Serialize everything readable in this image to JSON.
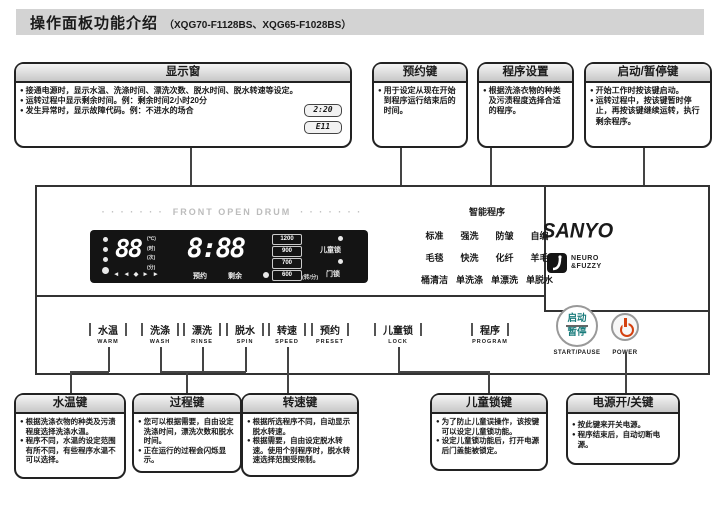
{
  "header": {
    "title": "操作面板功能介绍",
    "models": "（XQG70-F1128BS、XQG65-F1028BS）"
  },
  "callouts_top": {
    "display": {
      "title": "显示窗",
      "bullets": [
        "接通电源时，显示水温、洗涤时间、漂洗次数、脱水时间、脱水转速等设定。",
        "运转过程中显示剩余时间。例：剩余时间2小时20分",
        "发生异常时，显示故障代码。例：不进水的场合"
      ],
      "examples": [
        "2:20",
        "E11"
      ]
    },
    "preset": {
      "title": "预约键",
      "bullets": [
        "用于设定从现在开始到程序运行结束后的时间。"
      ]
    },
    "program": {
      "title": "程序设置",
      "bullets": [
        "根据洗涤衣物的种类及污渍程度选择合适的程序。"
      ]
    },
    "start_pause": {
      "title": "启动/暂停键",
      "bullets": [
        "开始工作时按该键启动。",
        "运转过程中，按该键暂时停止，再按该键继续运转，执行剩余程序。"
      ]
    }
  },
  "panel": {
    "dots": "· · · · · · ·",
    "drum_label": "FRONT OPEN DRUM",
    "display": {
      "value_digits": "88",
      "units": [
        "(℃)",
        "(时)",
        "(次)",
        "(分)"
      ],
      "arrows": "◄ ◄ ◆ ► ►",
      "time": "8:88",
      "time_label_left": "预约",
      "time_label_right": "剩余",
      "speeds": [
        "1200",
        "900",
        "700",
        "600"
      ],
      "speed_unit": "(转/分)",
      "child_lock_label": "儿童锁",
      "door_lock_label": "门锁"
    },
    "programs": {
      "title": "智能程序",
      "rows": [
        [
          "标准",
          "强洗",
          "防皱",
          "自编"
        ],
        [
          "毛毯",
          "快洗",
          "化纤",
          "羊毛"
        ],
        [
          "桶清洁",
          "单洗涤",
          "单漂洗",
          "单脱水"
        ]
      ]
    },
    "brand": {
      "name": "SANYO",
      "tagline_line1": "NEURO",
      "tagline_line2": "&FUZZY"
    },
    "buttons": [
      {
        "cn": "水温",
        "en": "WARM"
      },
      {
        "cn": "洗涤",
        "en": "WASH"
      },
      {
        "cn": "漂洗",
        "en": "RINSE"
      },
      {
        "cn": "脱水",
        "en": "SPIN"
      },
      {
        "cn": "转速",
        "en": "SPEED"
      },
      {
        "cn": "预约",
        "en": "PRESET"
      },
      {
        "cn": "儿童锁",
        "en": "LOCK"
      },
      {
        "cn": "程序",
        "en": "PROGRAM"
      }
    ],
    "start_button": {
      "line1": "启动",
      "line2": "暂停",
      "label": "START/PAUSE"
    },
    "power_button": {
      "label": "POWER"
    }
  },
  "callouts_bottom": {
    "water_temp": {
      "title": "水温键",
      "bullets": [
        "根据洗涤衣物的种类及污渍程度选择洗涤水温。",
        "程序不同，水温的设定范围有所不同，有些程序水温不可以选择。"
      ]
    },
    "process": {
      "title": "过程键",
      "bullets": [
        "您可以根据需要，自由设定洗涤时间，漂洗次数和脱水时间。",
        "正在运行的过程会闪烁显示。"
      ]
    },
    "speed": {
      "title": "转速键",
      "bullets": [
        "根据所选程序不同，自动显示脱水转速。",
        "根据需要，自由设定脱水转速。使用个别程序时，脱水转速选择范围受限制。"
      ]
    },
    "child_lock": {
      "title": "儿童锁键",
      "bullets": [
        "为了防止儿童误操作，该按键可以设定儿童锁功能。",
        "设定儿童锁功能后，打开电源后门盖能被锁定。"
      ]
    },
    "power": {
      "title": "电源开/关键",
      "bullets": [
        "按此键来开关电源。",
        "程序结束后，自动切断电源。"
      ]
    }
  },
  "colors": {
    "header_bg": "#d3d3d3",
    "display_bg": "#141414",
    "accent_teal": "#1a7c7c",
    "power_red": "#d4400e"
  }
}
